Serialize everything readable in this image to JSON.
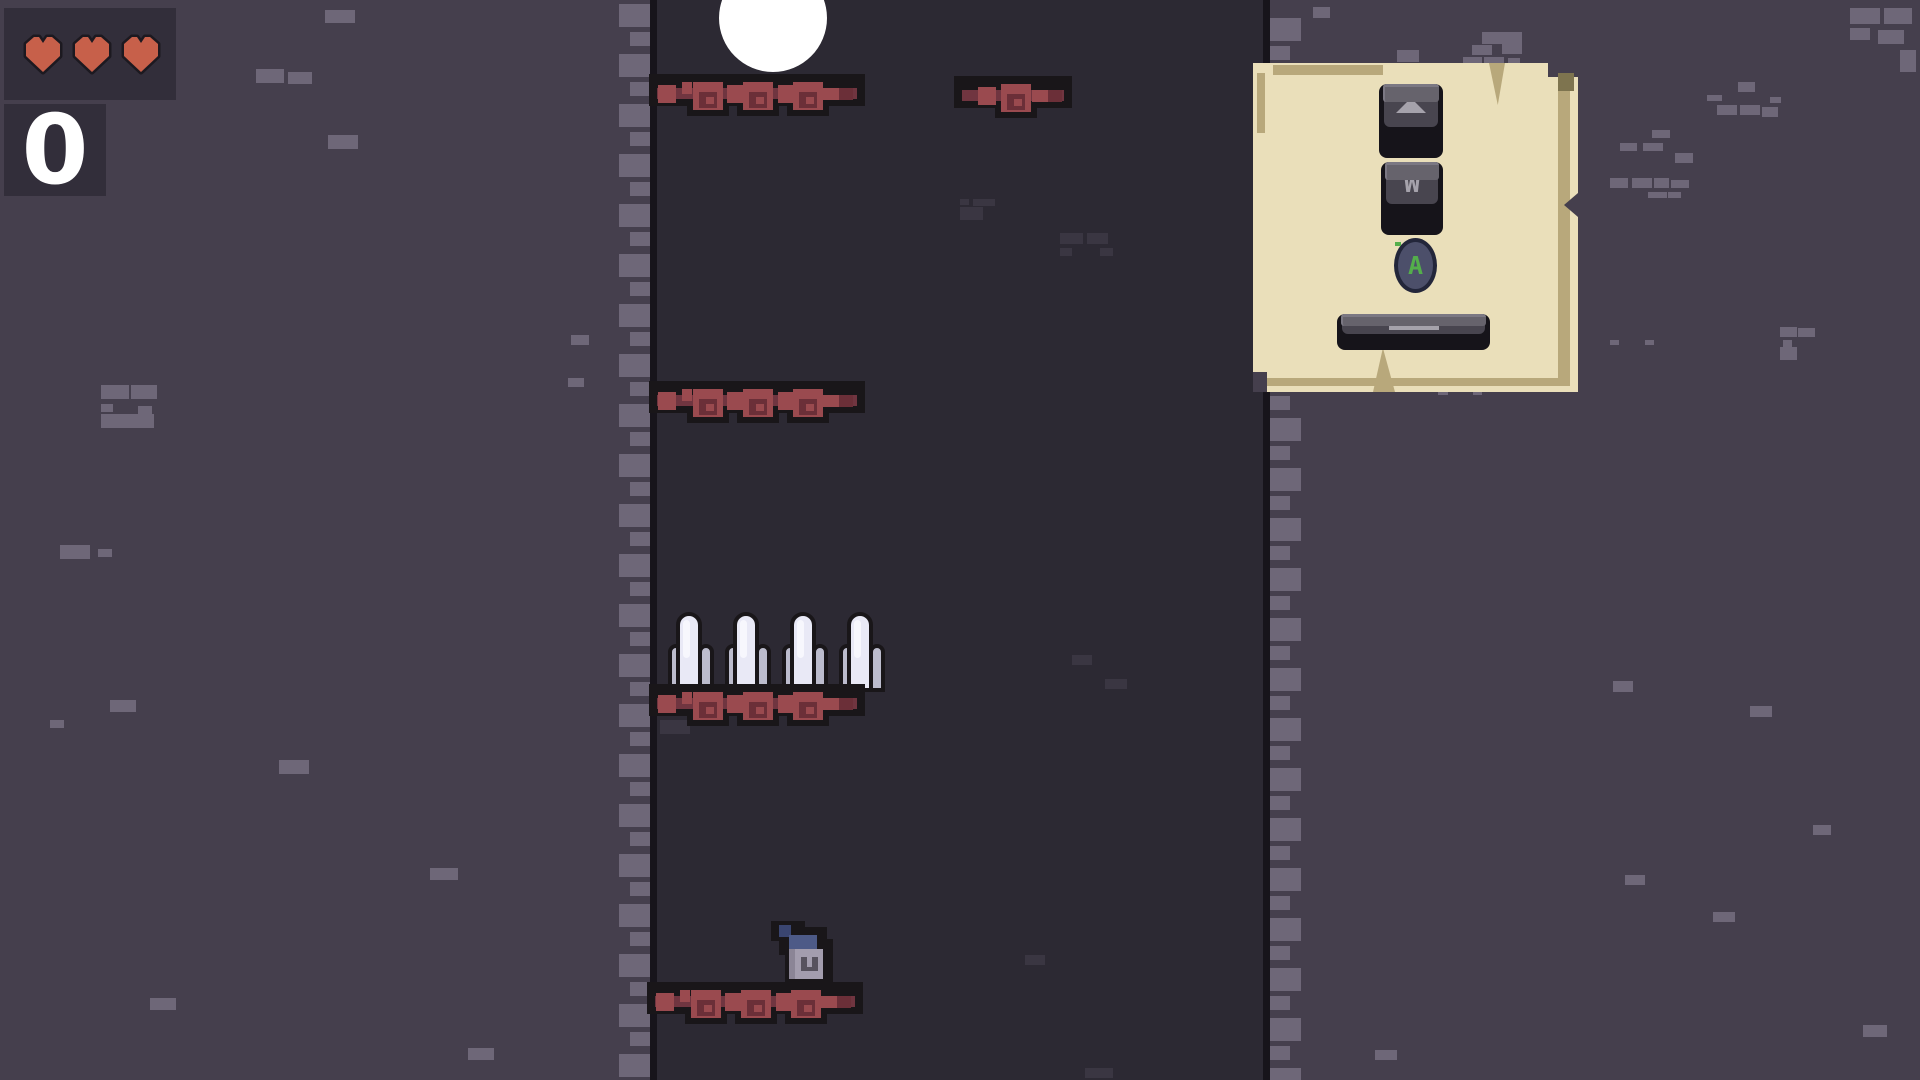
{
  "hud": {
    "hearts_count": 3,
    "counter_value": "0",
    "hearts_box": {
      "x": 4,
      "y": 8,
      "w": 172,
      "h": 92
    },
    "counter_box": {
      "x": 4,
      "y": 104,
      "w": 102,
      "h": 92
    },
    "colors": {
      "panel": "#322e3a",
      "heart_fill": "#c7604a",
      "heart_outline": "#1c1920",
      "counter_text": "#ffffff"
    }
  },
  "tutorial_sign": {
    "x": 1253,
    "y": 63,
    "w": 325,
    "h": 329,
    "colors": {
      "paper": "#eadfba",
      "shade": "#b8a87b",
      "dark_corner": "#7e744f",
      "key_top": "#48454f",
      "key_front": "#66636c",
      "key_highlight": "#7b7883",
      "key_outline": "#16141a",
      "glyph_gray": "#a5a2ab",
      "a_button": "#4c4f6a",
      "a_green": "#54ae4b"
    },
    "keys": [
      {
        "id": "up-arrow-key",
        "kind": "keycap-arrow",
        "glyph": "",
        "x": 126,
        "y": 21,
        "w": 64,
        "h": 74
      },
      {
        "id": "w-key",
        "kind": "keycap",
        "glyph": "W",
        "x": 128,
        "y": 99,
        "w": 62,
        "h": 73
      },
      {
        "id": "a-button",
        "kind": "round",
        "glyph": "A",
        "x": 141,
        "y": 175,
        "w": 43,
        "h": 55
      },
      {
        "id": "space-key",
        "kind": "spacebar",
        "glyph": "",
        "x": 84,
        "y": 251,
        "w": 153,
        "h": 36
      }
    ]
  },
  "scene": {
    "colors": {
      "bg_light": "#453f4d",
      "bg_shaft": "#2c2933",
      "brick_light": "#6e6778",
      "brick_shaft": "#3a3642",
      "wall_line": "#17141b",
      "platform_black": "#191619",
      "red_light": "#9a4a4f",
      "red_dark": "#6b2f38",
      "red_band": "#703540",
      "spike_center": "#e9e9f6",
      "spike_highlight": "#f7f7fd",
      "spike_side": "#bcbccd",
      "ball": "#ffffff"
    },
    "walls": {
      "left_line_x": 650,
      "right_line_x": 1263,
      "line_w": 7
    },
    "serration": {
      "period": 50,
      "count": 22,
      "big": {
        "w": 31,
        "h": 23,
        "dy": 4
      },
      "small": {
        "w": 20,
        "h": 14,
        "dy": 32
      }
    },
    "ball": {
      "x": 719,
      "y": -36,
      "d": 108
    },
    "character": {
      "x": 771,
      "y": 921,
      "w": 62,
      "h": 67
    },
    "platforms": [
      {
        "x": 657,
        "y": 80,
        "kind": "wide"
      },
      {
        "x": 962,
        "y": 82,
        "kind": "short"
      },
      {
        "x": 657,
        "y": 387,
        "kind": "wide"
      },
      {
        "x": 657,
        "y": 690,
        "kind": "wide"
      },
      {
        "x": 655,
        "y": 988,
        "kind": "wide"
      }
    ],
    "platform_kinds": {
      "wide": {
        "w": 200,
        "blocks": [
          {
            "t": "S",
            "dx": 1
          },
          {
            "t": "s",
            "dx": 25
          },
          {
            "t": "B",
            "dx": 36
          },
          {
            "t": "S",
            "dx": 70
          },
          {
            "t": "B",
            "dx": 86
          },
          {
            "t": "S",
            "dx": 121
          },
          {
            "t": "B",
            "dx": 136
          },
          {
            "t": "E",
            "dx": 166
          }
        ]
      },
      "short": {
        "w": 102,
        "blocks": [
          {
            "t": "S",
            "dx": 16
          },
          {
            "t": "B",
            "dx": 39
          },
          {
            "t": "E",
            "dx": 70
          }
        ]
      }
    },
    "spike_row": {
      "x": 668,
      "y": 612,
      "count": 4,
      "spacing": 57,
      "group_w": 46,
      "h": 80
    },
    "speckles_light": [
      [
        325,
        10,
        30,
        13
      ],
      [
        256,
        69,
        28,
        14
      ],
      [
        288,
        72,
        24,
        12
      ],
      [
        328,
        135,
        30,
        14
      ],
      [
        101,
        385,
        28,
        14
      ],
      [
        131,
        385,
        26,
        14
      ],
      [
        101,
        404,
        12,
        8
      ],
      [
        138,
        406,
        14,
        8
      ],
      [
        101,
        414,
        28,
        14
      ],
      [
        128,
        414,
        26,
        14
      ],
      [
        571,
        335,
        18,
        10
      ],
      [
        568,
        378,
        16,
        9
      ],
      [
        60,
        545,
        30,
        14
      ],
      [
        98,
        549,
        14,
        8
      ],
      [
        110,
        700,
        26,
        12
      ],
      [
        50,
        720,
        14,
        8
      ],
      [
        279,
        760,
        30,
        14
      ],
      [
        430,
        868,
        28,
        12
      ],
      [
        150,
        998,
        26,
        12
      ],
      [
        468,
        1048,
        26,
        12
      ],
      [
        1313,
        7,
        17,
        11
      ],
      [
        1397,
        50,
        22,
        12
      ],
      [
        1482,
        32,
        40,
        12
      ],
      [
        1472,
        45,
        20,
        10
      ],
      [
        1502,
        44,
        20,
        10
      ],
      [
        1463,
        57,
        19,
        10
      ],
      [
        1484,
        57,
        20,
        10
      ],
      [
        1508,
        58,
        12,
        9
      ],
      [
        1738,
        82,
        17,
        10
      ],
      [
        1707,
        95,
        15,
        6
      ],
      [
        1770,
        97,
        11,
        6
      ],
      [
        1717,
        105,
        20,
        10
      ],
      [
        1740,
        105,
        20,
        10
      ],
      [
        1762,
        107,
        16,
        10
      ],
      [
        1652,
        130,
        18,
        8
      ],
      [
        1620,
        143,
        17,
        8
      ],
      [
        1643,
        143,
        20,
        8
      ],
      [
        1675,
        153,
        18,
        10
      ],
      [
        1610,
        178,
        18,
        10
      ],
      [
        1632,
        178,
        20,
        10
      ],
      [
        1654,
        178,
        15,
        10
      ],
      [
        1671,
        180,
        18,
        8
      ],
      [
        1648,
        192,
        19,
        6
      ],
      [
        1668,
        192,
        13,
        6
      ],
      [
        1532,
        327,
        10,
        10
      ],
      [
        1552,
        340,
        12,
        7
      ],
      [
        1547,
        348,
        18,
        12
      ],
      [
        1610,
        340,
        9,
        5
      ],
      [
        1645,
        340,
        9,
        5
      ],
      [
        1780,
        327,
        17,
        10
      ],
      [
        1798,
        328,
        17,
        9
      ],
      [
        1783,
        340,
        9,
        7
      ],
      [
        1780,
        347,
        17,
        13
      ],
      [
        1438,
        375,
        20,
        12
      ],
      [
        1461,
        375,
        17,
        12
      ],
      [
        1438,
        388,
        10,
        7
      ],
      [
        1473,
        388,
        9,
        7
      ],
      [
        1613,
        681,
        20,
        11
      ],
      [
        1750,
        706,
        22,
        11
      ],
      [
        1813,
        825,
        18,
        10
      ],
      [
        1625,
        875,
        20,
        10
      ],
      [
        1713,
        912,
        22,
        10
      ],
      [
        1863,
        1025,
        24,
        12
      ],
      [
        1375,
        1050,
        22,
        10
      ],
      [
        1850,
        8,
        30,
        16
      ],
      [
        1884,
        8,
        28,
        16
      ],
      [
        1850,
        28,
        20,
        12
      ],
      [
        1878,
        30,
        26,
        14
      ],
      [
        1900,
        50,
        16,
        22
      ]
    ],
    "speckles_shaft": [
      [
        960,
        199,
        9,
        6
      ],
      [
        973,
        199,
        22,
        7
      ],
      [
        960,
        207,
        23,
        13
      ],
      [
        1060,
        233,
        23,
        11
      ],
      [
        1087,
        233,
        21,
        11
      ],
      [
        1060,
        248,
        12,
        8
      ],
      [
        1100,
        248,
        13,
        8
      ],
      [
        1072,
        655,
        20,
        10
      ],
      [
        1105,
        679,
        22,
        10
      ],
      [
        660,
        720,
        30,
        14
      ],
      [
        1025,
        955,
        20,
        10
      ],
      [
        1085,
        1068,
        28,
        10
      ]
    ]
  }
}
